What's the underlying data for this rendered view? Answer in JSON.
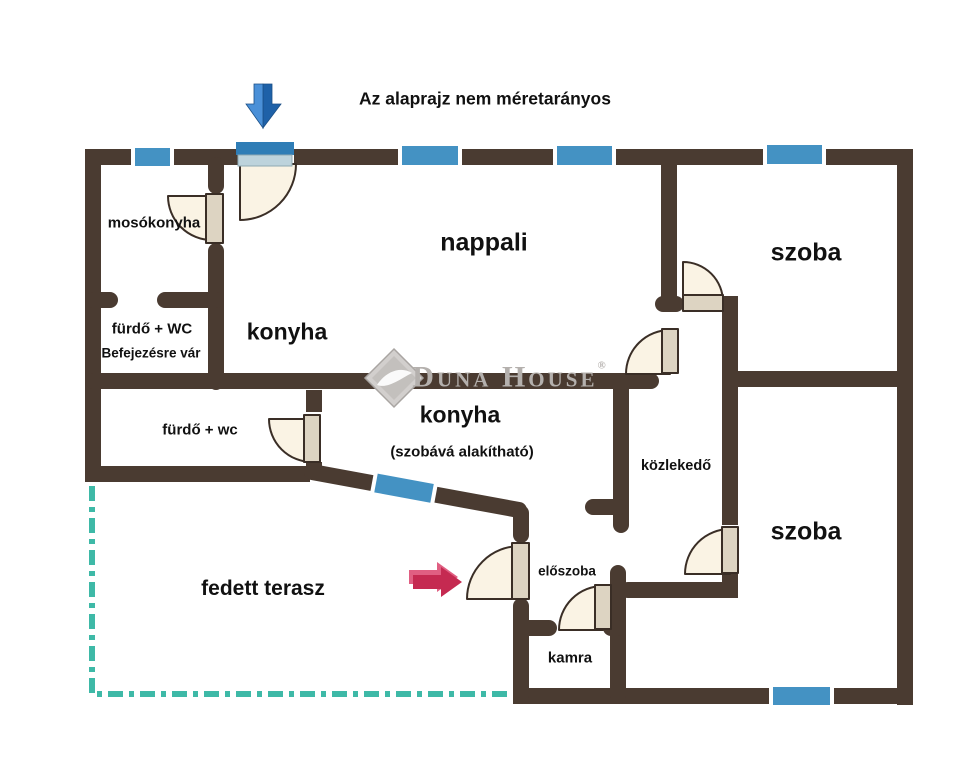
{
  "title": "Az alaprajz nem méretarányos",
  "rooms": {
    "mosokonyha": "mosókonyha",
    "nappali": "nappali",
    "szoba_top": "szoba",
    "furdo_wc_upper": "fürdő + WC",
    "furdo_wc_upper_note": "Befejezésre vár",
    "konyha_upper": "konyha",
    "furdo_wc_lower": "fürdő + wc",
    "konyha_lower": "konyha",
    "konyha_lower_note": "(szobává alakítható)",
    "kozlekedo": "közlekedő",
    "szoba_bottom": "szoba",
    "fedett_terasz": "fedett terasz",
    "eloszoba": "előszoba",
    "kamra": "kamra"
  },
  "watermark": {
    "brand": "Duna House",
    "registered": "®"
  },
  "icons": {
    "north_entry_marker": "blue-down-arrow-icon",
    "main_entrance_marker": "red-right-arrow-icon",
    "window_marker": "blue-window-band",
    "door_marker": "quarter-circle-door-swing",
    "terrace_boundary": "teal-dash-dot-line",
    "brand_logo": "duna-house-diamond-logo"
  },
  "colors": {
    "wall": "#4a3b31",
    "window_blue": "#4492c3",
    "entrance_transom_dark": "#2f7db6",
    "entrance_transom_light": "#bdd3dc",
    "door_swing_fill": "#faf3e4",
    "door_leaf_fill": "#ddd4c2",
    "door_outline": "#3a2e26",
    "terrace_dash_teal": "#3eb9a7",
    "north_arrow_light": "#4a90d8",
    "north_arrow_dark": "#1e61a8",
    "entrance_arrow_main": "#c52a51",
    "entrance_arrow_highlight": "#e05f82",
    "watermark_grey": "#b4b0ad",
    "text": "#111111",
    "background": "#ffffff"
  }
}
